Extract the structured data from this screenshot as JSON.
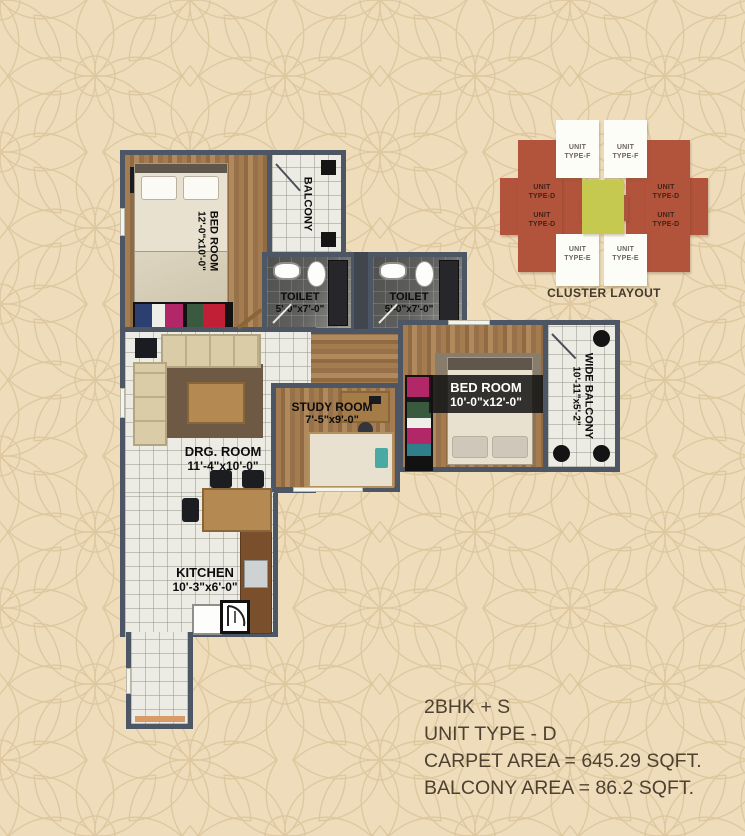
{
  "page": {
    "background_color": "#eedcba",
    "pattern_color": "#dcc49a"
  },
  "floor_plan": {
    "rooms": {
      "bedroom1": {
        "name": "BED ROOM",
        "dims": "12'-0\"x10'-0\""
      },
      "balcony": {
        "name": "BALCONY"
      },
      "toilet1": {
        "name": "TOILET",
        "dims": "5'-0\"x7'-0\""
      },
      "toilet2": {
        "name": "TOILET",
        "dims": "5'-0\"x7'-0\""
      },
      "drawing_room": {
        "name": "DRG. ROOM",
        "dims": "11'-4\"x10'-0\""
      },
      "study_room": {
        "name": "STUDY ROOM",
        "dims": "7'-5\"x9'-0\""
      },
      "bedroom2": {
        "name": "BED ROOM",
        "dims": "10'-0\"x12'-0\""
      },
      "wide_balcony": {
        "name": "WIDE BALCONY",
        "dims": "10'-11\"x5'-2\""
      },
      "kitchen": {
        "name": "KITCHEN",
        "dims": "10'-3\"x6'-0\""
      }
    },
    "colors": {
      "wall": "#4d5665",
      "wood_floor": "#9c7a50",
      "tile_floor": "#ecece5",
      "toilet_floor": "#5c5c58"
    }
  },
  "cluster_layout": {
    "caption": "CLUSTER LAYOUT",
    "units": [
      {
        "l1": "UNIT",
        "l2": "TYPE-D"
      },
      {
        "l1": "UNIT",
        "l2": "TYPE-D"
      },
      {
        "l1": "UNIT",
        "l2": "TYPE-D"
      },
      {
        "l1": "UNIT",
        "l2": "TYPE-D"
      },
      {
        "l1": "UNIT",
        "l2": "TYPE-F"
      },
      {
        "l1": "UNIT",
        "l2": "TYPE-F"
      },
      {
        "l1": "UNIT",
        "l2": "TYPE-E"
      },
      {
        "l1": "UNIT",
        "l2": "TYPE-E"
      }
    ],
    "colors": {
      "unit_type_d": "#b2533c",
      "unit_type_e_f": "#fdfdf8",
      "central_core": "#c6c94f"
    }
  },
  "info_block": {
    "bhk": "2BHK + S",
    "unit_type": "UNIT TYPE - D",
    "carpet_area": "CARPET AREA = 645.29 SQFT.",
    "balcony_area": "BALCONY AREA = 86.2 SQFT."
  }
}
